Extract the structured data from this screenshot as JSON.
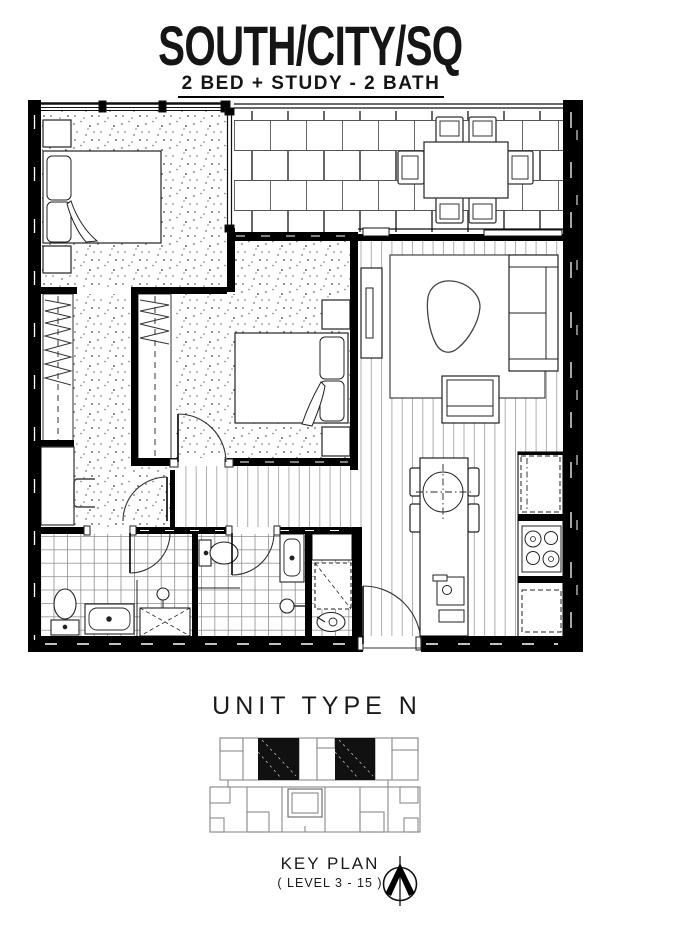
{
  "header": {
    "title": "SOUTH/CITY/SQ",
    "subtitle": "2 BED + STUDY - 2 BATH"
  },
  "unit": {
    "label": "UNIT TYPE N"
  },
  "key_plan": {
    "title": "KEY PLAN",
    "level": "( LEVEL 3 - 15 )",
    "highlighted_units": 2,
    "highlight_color": "#111111",
    "outline_color": "#8a8a8a"
  },
  "icons": {
    "north_arrow": "north-arrow-compass"
  },
  "colors": {
    "ink": "#111111",
    "wall": "#000000",
    "paper": "#ffffff",
    "floor_pattern": "#8a8a8a"
  },
  "floor_plan": {
    "rooms": [
      "master-bedroom",
      "walk-in-robe",
      "study-nook",
      "bedroom-2",
      "balcony-terrace",
      "living-room",
      "dining-area",
      "kitchen",
      "ensuite",
      "bathroom",
      "laundry",
      "entry-hall"
    ]
  }
}
